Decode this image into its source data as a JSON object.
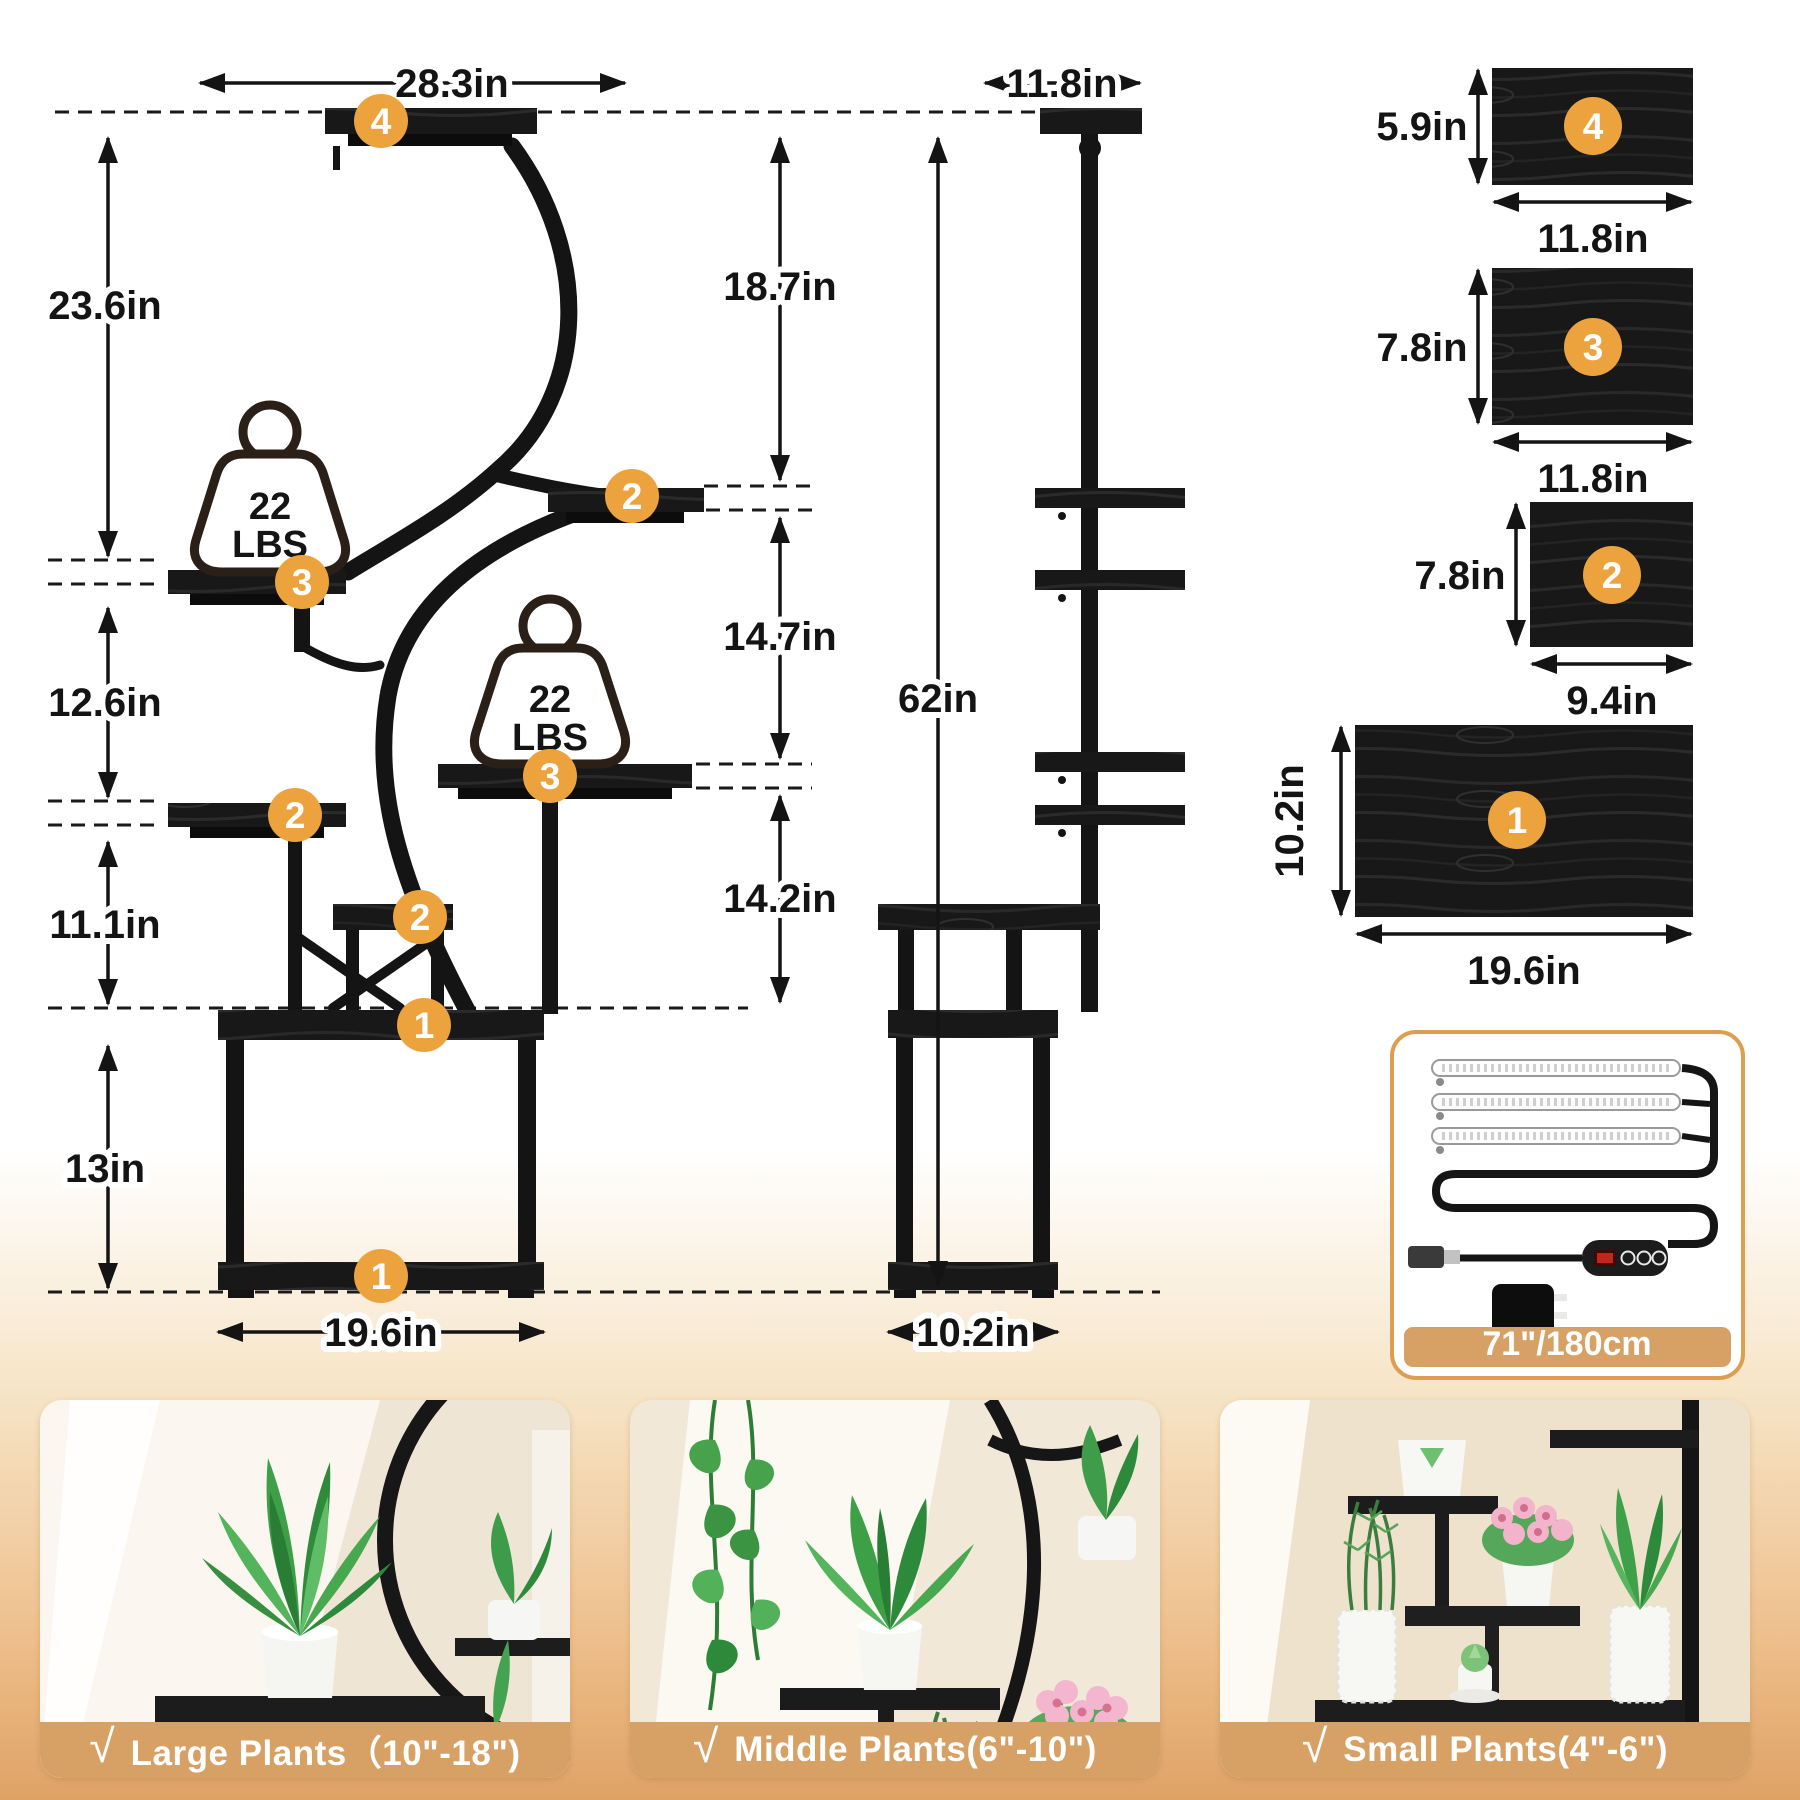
{
  "front_view": {
    "top_width_label": "28.3in",
    "height_labels": {
      "h1": "23.6in",
      "h2": "12.6in",
      "h3": "11.1in",
      "h4": "13in"
    },
    "right_height_labels": {
      "r1": "18.7in",
      "r2": "14.7in",
      "r3": "14.2in"
    },
    "total_height_label": "62in",
    "base_width_label": "19.6in",
    "weight_label": {
      "line1": "22",
      "line2": "LBS"
    },
    "badges": {
      "shelf4": "4",
      "shelf2_right": "2",
      "shelf3_left": "3",
      "shelf3_right": "3",
      "shelf2_left": "2",
      "shelf2_mid": "2",
      "platform": "1",
      "base": "1"
    }
  },
  "side_view": {
    "top_width_label": "11.8in",
    "base_width_label": "10.2in"
  },
  "panels": [
    {
      "number": "4",
      "height_label": "5.9in",
      "width_label": "11.8in"
    },
    {
      "number": "3",
      "height_label": "7.8in",
      "width_label": "11.8in"
    },
    {
      "number": "2",
      "height_label": "7.8in",
      "width_label": "9.4in"
    },
    {
      "number": "1",
      "height_label": "10.2in",
      "width_label": "19.6in"
    }
  ],
  "light_kit": {
    "length_label": "71\"/180cm"
  },
  "plant_cards": [
    {
      "check": "√",
      "label": "Large Plants（10\"-18\")"
    },
    {
      "check": "√",
      "label": "Middle Plants(6\"-10\")"
    },
    {
      "check": "√",
      "label": "Small Plants(4\"-6\")"
    }
  ],
  "colors": {
    "badge": "#ECA33E",
    "tan": "#D7A165",
    "frame": "#141414",
    "kit_border": "#DE9E52"
  }
}
